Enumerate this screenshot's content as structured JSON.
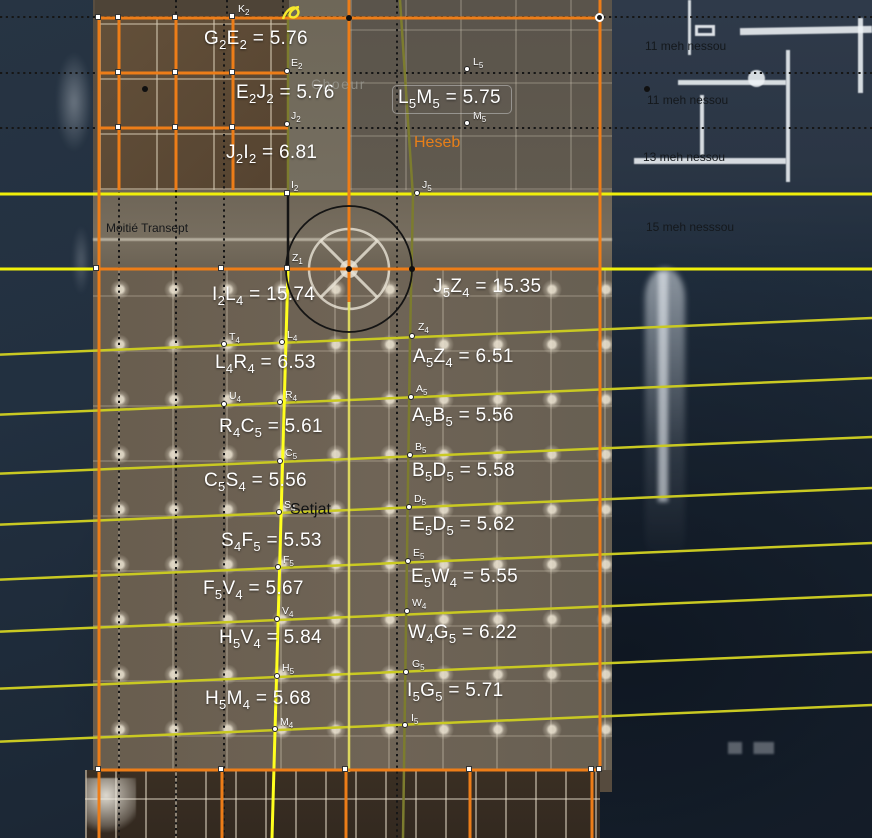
{
  "canvas": {
    "width": 872,
    "height": 838
  },
  "colors": {
    "orange": "#ed7d18",
    "yellow": "#f0ef0a",
    "yellow_bright": "#ffff1e",
    "fan_yellow": "#c9c922",
    "olive": "#7c7c2e",
    "pale_yellow": "#e9e45f",
    "dotted_black": "#161616",
    "circle_black": "#141414",
    "label_white": "#ffffff",
    "heseb_orange": "#e87f18"
  },
  "overlay": {
    "measurements": [
      {
        "t1": "G",
        "s1": "2",
        "t2": "E",
        "s2": "2",
        "val": "5.76",
        "x": 204,
        "y": 28
      },
      {
        "t1": "E",
        "s1": "2",
        "t2": "J",
        "s2": "2",
        "val": "5.76",
        "x": 236,
        "y": 82
      },
      {
        "t1": "J",
        "s1": "2",
        "t2": "I",
        "s2": "2",
        "val": "6.81",
        "x": 226,
        "y": 142
      },
      {
        "t1": "L",
        "s1": "5",
        "t2": "M",
        "s2": "5",
        "val": "5.75",
        "x": 398,
        "y": 88,
        "boxed": true
      },
      {
        "t1": "I",
        "s1": "2",
        "t2": "L",
        "s2": "4",
        "val": "15.74",
        "x": 212,
        "y": 284
      },
      {
        "t1": "J",
        "s1": "5",
        "t2": "Z",
        "s2": "4",
        "val": "15.35",
        "x": 433,
        "y": 276
      },
      {
        "t1": "L",
        "s1": "4",
        "t2": "R",
        "s2": "4",
        "val": "6.53",
        "x": 215,
        "y": 352
      },
      {
        "t1": "A",
        "s1": "5",
        "t2": "Z",
        "s2": "4",
        "val": "6.51",
        "x": 413,
        "y": 346
      },
      {
        "t1": "R",
        "s1": "4",
        "t2": "C",
        "s2": "5",
        "val": "5.61",
        "x": 219,
        "y": 416
      },
      {
        "t1": "A",
        "s1": "5",
        "t2": "B",
        "s2": "5",
        "val": "5.56",
        "x": 412,
        "y": 405
      },
      {
        "t1": "C",
        "s1": "5",
        "t2": "S",
        "s2": "4",
        "val": "5.56",
        "x": 204,
        "y": 470
      },
      {
        "t1": "B",
        "s1": "5",
        "t2": "D",
        "s2": "5",
        "val": "5.58",
        "x": 412,
        "y": 460
      },
      {
        "t1": "S",
        "s1": "4",
        "t2": "F",
        "s2": "5",
        "val": "5.53",
        "x": 221,
        "y": 530
      },
      {
        "t1": "E",
        "s1": "5",
        "t2": "D",
        "s2": "5",
        "val": "5.62",
        "x": 412,
        "y": 514
      },
      {
        "t1": "F",
        "s1": "5",
        "t2": "V",
        "s2": "4",
        "val": "5.67",
        "x": 203,
        "y": 578
      },
      {
        "t1": "E",
        "s1": "5",
        "t2": "W",
        "s2": "4",
        "val": "5.55",
        "x": 411,
        "y": 566
      },
      {
        "t1": "H",
        "s1": "5",
        "t2": "V",
        "s2": "4",
        "val": "5.84",
        "x": 219,
        "y": 627
      },
      {
        "t1": "W",
        "s1": "4",
        "t2": "G",
        "s2": "5",
        "val": "6.22",
        "x": 408,
        "y": 622
      },
      {
        "t1": "H",
        "s1": "5",
        "t2": "M",
        "s2": "4",
        "val": "5.68",
        "x": 205,
        "y": 688
      },
      {
        "t1": "I",
        "s1": "5",
        "t2": "G",
        "s2": "5",
        "val": "5.71",
        "x": 407,
        "y": 680
      }
    ],
    "points": [
      {
        "l": "K",
        "s": "2",
        "x": 233,
        "y": 17,
        "m": "square",
        "lx": 238,
        "ly": 3
      },
      {
        "l": "E",
        "s": "2",
        "x": 288,
        "y": 72,
        "m": "dot",
        "lx": 291,
        "ly": 57
      },
      {
        "l": "J",
        "s": "2",
        "x": 288,
        "y": 125,
        "m": "dot",
        "lx": 291,
        "ly": 110
      },
      {
        "l": "I",
        "s": "2",
        "x": 288,
        "y": 194,
        "m": "square",
        "lx": 291,
        "ly": 179
      },
      {
        "l": "L",
        "s": "5",
        "x": 468,
        "y": 70,
        "m": "dot",
        "lx": 473,
        "ly": 56
      },
      {
        "l": "M",
        "s": "5",
        "x": 468,
        "y": 124,
        "m": "dot",
        "lx": 473,
        "ly": 110
      },
      {
        "l": "J",
        "s": "5",
        "x": 418,
        "y": 194,
        "m": "dot",
        "lx": 422,
        "ly": 179
      },
      {
        "l": "Z",
        "s": "1",
        "x": 288,
        "y": 269,
        "m": "square",
        "lx": 292,
        "ly": 252
      },
      {
        "l": "T",
        "s": "4",
        "x": 225,
        "y": 345,
        "m": "dot",
        "lx": 229,
        "ly": 331
      },
      {
        "l": "L",
        "s": "4",
        "x": 283,
        "y": 343,
        "m": "dot",
        "lx": 287,
        "ly": 329
      },
      {
        "l": "Z",
        "s": "4",
        "x": 413,
        "y": 337,
        "m": "dot",
        "lx": 418,
        "ly": 321
      },
      {
        "l": "U",
        "s": "4",
        "x": 225,
        "y": 405,
        "m": "dot",
        "lx": 229,
        "ly": 390
      },
      {
        "l": "R",
        "s": "4",
        "x": 281,
        "y": 403,
        "m": "dot",
        "lx": 285,
        "ly": 389
      },
      {
        "l": "A",
        "s": "5",
        "x": 412,
        "y": 398,
        "m": "dot",
        "lx": 416,
        "ly": 383
      },
      {
        "l": "C",
        "s": "5",
        "x": 281,
        "y": 462,
        "m": "dot",
        "lx": 285,
        "ly": 447
      },
      {
        "l": "B",
        "s": "5",
        "x": 411,
        "y": 456,
        "m": "dot",
        "lx": 415,
        "ly": 441
      },
      {
        "l": "S",
        "s": "4",
        "x": 280,
        "y": 513,
        "m": "dot",
        "lx": 284,
        "ly": 499
      },
      {
        "l": "D",
        "s": "5",
        "x": 410,
        "y": 508,
        "m": "dot",
        "lx": 414,
        "ly": 493
      },
      {
        "l": "F",
        "s": "5",
        "x": 279,
        "y": 568,
        "m": "dot",
        "lx": 283,
        "ly": 554
      },
      {
        "l": "E",
        "s": "5",
        "x": 409,
        "y": 562,
        "m": "dot",
        "lx": 413,
        "ly": 547
      },
      {
        "l": "V",
        "s": "4",
        "x": 278,
        "y": 620,
        "m": "dot",
        "lx": 282,
        "ly": 605
      },
      {
        "l": "W",
        "s": "4",
        "x": 408,
        "y": 612,
        "m": "dot",
        "lx": 412,
        "ly": 597
      },
      {
        "l": "H",
        "s": "5",
        "x": 278,
        "y": 677,
        "m": "dot",
        "lx": 282,
        "ly": 662
      },
      {
        "l": "G",
        "s": "5",
        "x": 407,
        "y": 673,
        "m": "dot",
        "lx": 412,
        "ly": 658
      },
      {
        "l": "M",
        "s": "4",
        "x": 276,
        "y": 730,
        "m": "dot",
        "lx": 280,
        "ly": 716
      },
      {
        "l": "I",
        "s": "5",
        "x": 406,
        "y": 726,
        "m": "dot",
        "lx": 411,
        "ly": 712
      }
    ],
    "texts": [
      {
        "name": "choeur-label",
        "text": "Choeur",
        "x": 311,
        "y": 76,
        "cls": "choeur"
      },
      {
        "name": "heseb-label",
        "text": "Heseb",
        "x": 414,
        "y": 134,
        "cls": "heseb"
      },
      {
        "name": "moitie-transept-label",
        "text": "Moitié Transept",
        "x": 106,
        "y": 221,
        "cls": "annot-black"
      },
      {
        "name": "setjat-label",
        "text": "Setjat",
        "x": 290,
        "y": 501,
        "cls": "setjat"
      },
      {
        "name": "meh-nessou-1",
        "text": "11 meh nessou",
        "x": 645,
        "y": 39,
        "cls": "meh"
      },
      {
        "name": "meh-nessou-2",
        "text": "11 meh nessou",
        "x": 647,
        "y": 93,
        "cls": "meh"
      },
      {
        "name": "meh-nessou-3",
        "text": "13 meh nessou",
        "x": 643,
        "y": 150,
        "cls": "meh"
      },
      {
        "name": "meh-nessou-4",
        "text": "15 meh nesssou",
        "x": 646,
        "y": 220,
        "cls": "meh"
      }
    ],
    "markers": {
      "squares": [
        [
          99,
          18
        ],
        [
          119,
          18
        ],
        [
          176,
          18
        ],
        [
          119,
          73
        ],
        [
          176,
          73
        ],
        [
          233,
          73
        ],
        [
          119,
          128
        ],
        [
          176,
          128
        ],
        [
          233,
          128
        ],
        [
          97,
          269
        ],
        [
          222,
          269
        ],
        [
          99,
          770
        ],
        [
          222,
          770
        ],
        [
          346,
          770
        ],
        [
          470,
          770
        ],
        [
          592,
          770
        ],
        [
          600,
          770
        ]
      ],
      "black_dots": [
        [
          145,
          89
        ],
        [
          647,
          89
        ],
        [
          349,
          18
        ],
        [
          349,
          269
        ],
        [
          412,
          269
        ]
      ],
      "rings": [
        [
          600,
          18
        ]
      ]
    }
  },
  "lines": {
    "dotted_horizontals": [
      {
        "y": 17,
        "x1": 0,
        "x2": 872
      },
      {
        "y": 73,
        "x1": 0,
        "x2": 872
      },
      {
        "y": 128,
        "x1": 0,
        "x2": 872
      }
    ],
    "dotted_verticals": [
      {
        "x": 119,
        "y1": 18,
        "y2": 838
      },
      {
        "x": 176,
        "y1": 190,
        "y2": 838
      },
      {
        "x": 224,
        "y1": 18,
        "y2": 838
      },
      {
        "x": 397,
        "y1": 0,
        "y2": 838
      },
      {
        "x": 176,
        "y1": 0,
        "y2": 18
      },
      {
        "x": 227,
        "y1": 0,
        "y2": 18
      },
      {
        "x": 283,
        "y1": 0,
        "y2": 18
      }
    ],
    "yellow_horizontals": [
      {
        "y": 194,
        "x1": 0,
        "x2": 872
      },
      {
        "y": 269,
        "x1": 0,
        "x2": 872
      }
    ],
    "fan_rows": [
      343,
      403,
      462,
      513,
      568,
      620,
      677,
      730
    ],
    "fan_anchor_x": 278,
    "fan_slope": -0.042,
    "orange_segments": [
      [
        99,
        18,
        600,
        18
      ],
      [
        99,
        73,
        288,
        73
      ],
      [
        99,
        128,
        288,
        128
      ],
      [
        97,
        269,
        600,
        269
      ],
      [
        97,
        770,
        600,
        770
      ],
      [
        99,
        18,
        99,
        838
      ],
      [
        119,
        18,
        119,
        190
      ],
      [
        176,
        18,
        176,
        190
      ],
      [
        233,
        18,
        233,
        190
      ],
      [
        349,
        0,
        349,
        302
      ],
      [
        600,
        0,
        600,
        770
      ],
      [
        222,
        770,
        222,
        838
      ],
      [
        346,
        770,
        346,
        838
      ],
      [
        470,
        770,
        470,
        838
      ],
      [
        592,
        770,
        592,
        838
      ]
    ],
    "axis": {
      "olive_left": [
        288,
        14,
        288,
        194
      ],
      "black_segment": [
        288,
        194,
        288,
        269
      ],
      "yellow_left": [
        288,
        269,
        272,
        838
      ],
      "olive_right_path": "M400,0 L413,197 L410,340 L403,838",
      "pale_center": [
        349,
        300,
        349,
        772
      ]
    },
    "circle": {
      "cx": 349,
      "cy": 269,
      "r": 63
    },
    "scribble_path": "M283,19 C286,10 293,5 297,9 C301,13 296,19 291,17 C287,15 292,8 299,7"
  }
}
